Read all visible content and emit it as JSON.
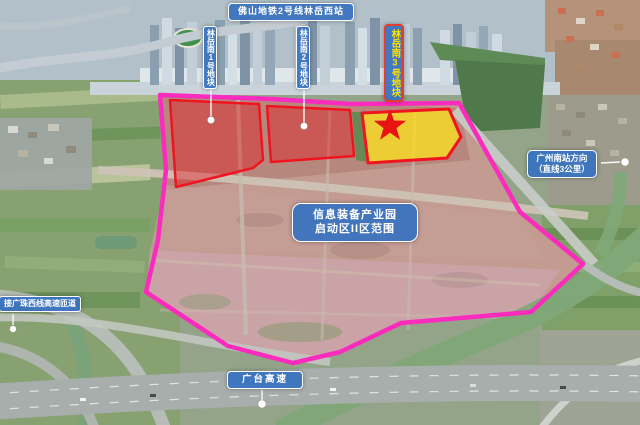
{
  "annotations": {
    "metro_station": {
      "label": "佛山地铁2号线林岳西站"
    },
    "plot1": {
      "label": "林岳南1号地块"
    },
    "plot2": {
      "label": "林岳南2号地块"
    },
    "plot3": {
      "label": "林岳南3号地块",
      "marker_icon": "star"
    },
    "park": {
      "line1": "信息装备产业园",
      "line2": "启动区II区范围"
    },
    "gz_south": {
      "line1": "广州南站方向",
      "line2": "（直线3公里）"
    },
    "ramp": {
      "label": "接广珠西线高速匝道"
    },
    "expressway": {
      "label": "广台高速"
    }
  },
  "colors": {
    "site_boundary": "#fb2bbd",
    "plot_outline": "#f01420",
    "plot_fill_red": "rgba(230,24,34,0.42)",
    "plot_fill_yellow": "rgba(252,224,32,0.78)",
    "label_bg": "#3872be",
    "label_border": "#ffffff",
    "label_text": "#ffffff",
    "plot3_label_text": "#ffe100",
    "plot3_label_border": "#e63c30",
    "star": "#ea1313"
  }
}
